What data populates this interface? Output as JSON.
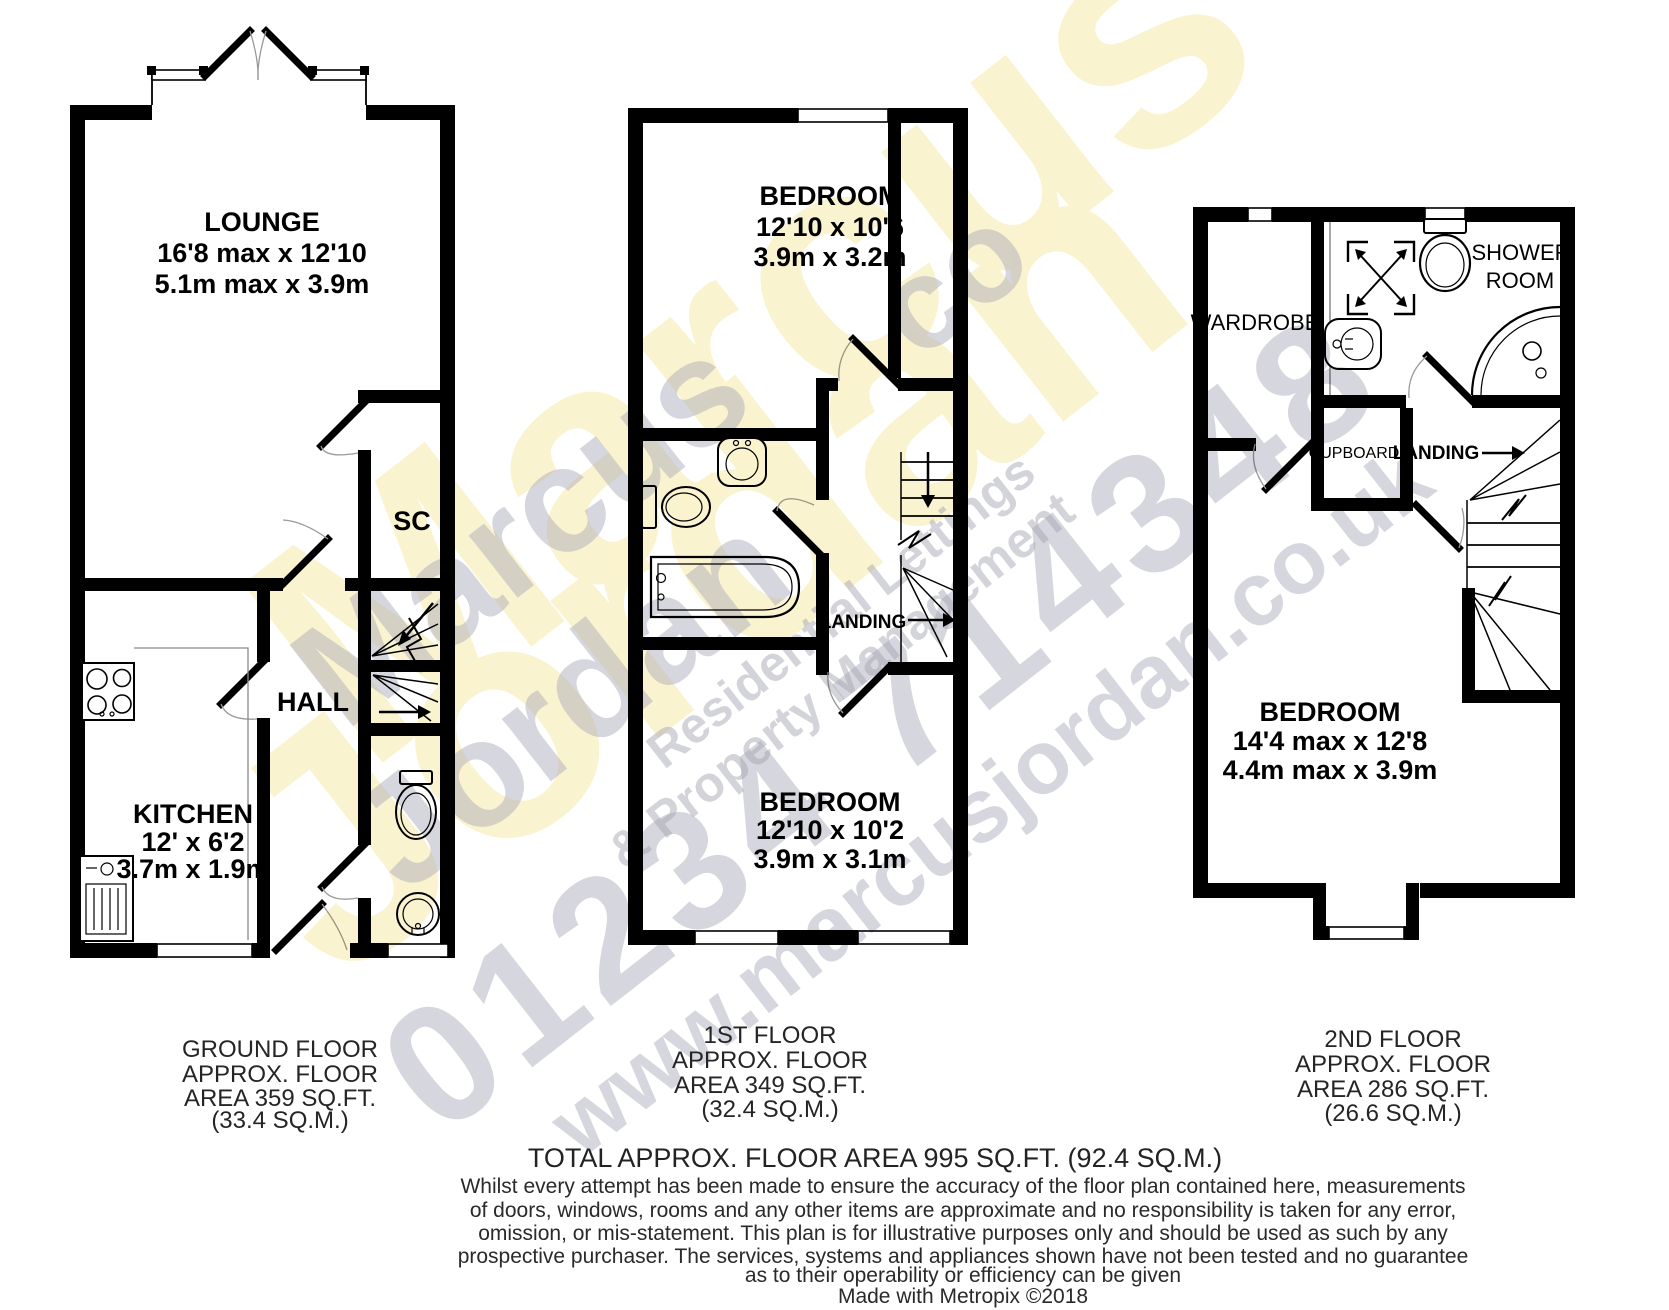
{
  "watermark": {
    "brand_top": "Marcus",
    "brand_bottom": "Jordan",
    "tagline1": "Residential Lettings",
    "tagline2": "& Property Management",
    "phone": "01234 714348",
    "website": "www.marcusjordan.co.uk",
    "suffix": "co",
    "accent_yellow": "#faf3ce",
    "accent_gray": "#a5a5b5"
  },
  "ground_floor": {
    "lounge_name": "LOUNGE",
    "lounge_ft": "16'8 max x 12'10",
    "lounge_m": "5.1m max x 3.9m",
    "sc": "SC",
    "hall": "HALL",
    "kitchen_name": "KITCHEN",
    "kitchen_ft": "12' x 6'2",
    "kitchen_m": "3.7m x 1.9m",
    "caption1": "GROUND FLOOR",
    "caption2": "APPROX. FLOOR",
    "caption3": "AREA 359 SQ.FT.",
    "caption4": "(33.4 SQ.M.)"
  },
  "first_floor": {
    "bedroom1_name": "BEDROOM",
    "bedroom1_ft": "12'10 x 10'6",
    "bedroom1_m": "3.9m x 3.2m",
    "landing": "LANDING",
    "bedroom2_name": "BEDROOM",
    "bedroom2_ft": "12'10 x 10'2",
    "bedroom2_m": "3.9m x 3.1m",
    "caption1": "1ST FLOOR",
    "caption2": "APPROX. FLOOR",
    "caption3": "AREA 349 SQ.FT.",
    "caption4": "(32.4 SQ.M.)"
  },
  "second_floor": {
    "wardrobe": "WARDROBE",
    "shower1": "SHOWER",
    "shower2": "ROOM",
    "cupboard": "CUPBOARD",
    "landing": "LANDING",
    "bedroom_name": "BEDROOM",
    "bedroom_ft": "14'4 max x 12'8",
    "bedroom_m": "4.4m max x 3.9m",
    "caption1": "2ND FLOOR",
    "caption2": "APPROX. FLOOR",
    "caption3": "AREA 286 SQ.FT.",
    "caption4": "(26.6 SQ.M.)"
  },
  "footer": {
    "total": "TOTAL APPROX. FLOOR AREA 995 SQ.FT. (92.4 SQ.M.)",
    "disclaimer1": "Whilst every attempt has been made to ensure the accuracy of the floor plan contained here, measurements",
    "disclaimer2": "of doors, windows, rooms and any other items are approximate and no responsibility is taken for any error,",
    "disclaimer3": "omission, or mis-statement. This plan is for illustrative purposes only and should be used as such by any",
    "disclaimer4": "prospective purchaser. The services, systems and appliances shown have not been tested and no guarantee",
    "disclaimer5": "as to their operability or efficiency can be given",
    "credit": "Made with Metropix ©2018"
  }
}
